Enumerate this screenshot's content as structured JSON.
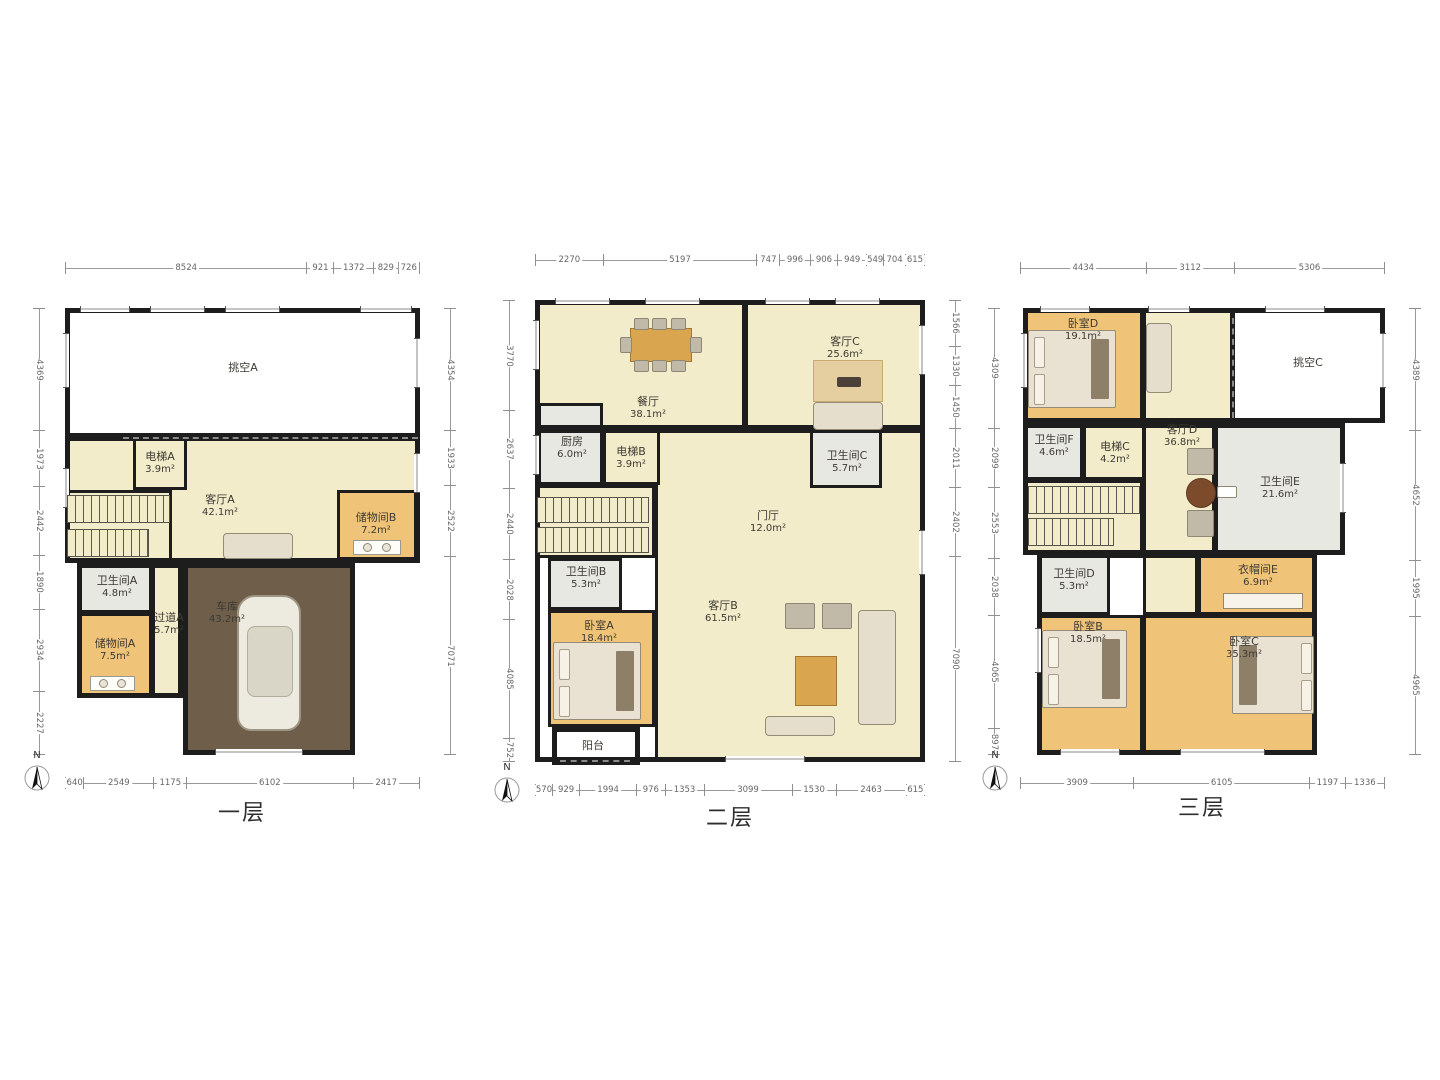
{
  "compass": {
    "label": "N"
  },
  "colors": {
    "floor": "#f3ecca",
    "wood": "#f0c478",
    "gray": "#e8e8e3",
    "garage": "#6e5e4a",
    "void": "#ffffff",
    "wall": "#1d1d1d",
    "dim_text": "#666666"
  },
  "floors": [
    {
      "label": "一层",
      "plan": {
        "x": 65,
        "y": 308,
        "w": 355,
        "h": 447
      },
      "label_pos": {
        "x": 242,
        "y": 795
      },
      "compass_pos": {
        "x": 22,
        "y": 750
      },
      "dims": {
        "top": [
          "8524",
          "921",
          "1372",
          "829",
          "726"
        ],
        "left": [
          "4369",
          "1973",
          "2442",
          "1890",
          "2934",
          "2227"
        ],
        "right": [
          "4354",
          "1933",
          "2522",
          "7071"
        ],
        "bottom": [
          "640",
          "2549",
          "1175",
          "6102",
          "2417"
        ]
      },
      "rooms": [
        {
          "key": "void-a",
          "name": "挑空A",
          "area": "",
          "x": 0,
          "y": 0,
          "w": 355,
          "h": 130,
          "fill": "void",
          "lx": 178,
          "ly": 60
        },
        {
          "key": "living-a",
          "name": "客厅A",
          "area": "42.1m²",
          "x": 0,
          "y": 128,
          "w": 355,
          "h": 127,
          "fill": "floor",
          "lx": 155,
          "ly": 198
        },
        {
          "key": "elevator-a",
          "name": "电梯A",
          "area": "3.9m²",
          "x": 68,
          "y": 128,
          "w": 54,
          "h": 54,
          "fill": "floor",
          "lx": 95,
          "ly": 155
        },
        {
          "key": "storage-b",
          "name": "储物间B",
          "area": "7.2m²",
          "x": 272,
          "y": 182,
          "w": 80,
          "h": 70,
          "fill": "wood",
          "lx": 311,
          "ly": 216
        },
        {
          "key": "stairwell-1",
          "name": "",
          "area": "",
          "x": 0,
          "y": 182,
          "w": 107,
          "h": 73,
          "fill": "floor"
        },
        {
          "key": "bath-a",
          "name": "卫生间A",
          "area": "4.8m²",
          "x": 13,
          "y": 255,
          "w": 74,
          "h": 50,
          "fill": "gray",
          "lx": 52,
          "ly": 279
        },
        {
          "key": "corridor-a",
          "name": "过道A",
          "area": "5.7m²",
          "x": 87,
          "y": 255,
          "w": 31,
          "h": 135,
          "fill": "floor",
          "lx": 104,
          "ly": 316
        },
        {
          "key": "storage-a",
          "name": "储物间A",
          "area": "7.5m²",
          "x": 12,
          "y": 305,
          "w": 75,
          "h": 85,
          "fill": "wood",
          "lx": 50,
          "ly": 342
        },
        {
          "key": "garage",
          "name": "车库",
          "area": "43.2m²",
          "x": 118,
          "y": 255,
          "w": 172,
          "h": 192,
          "fill": "garage",
          "lx": 162,
          "ly": 305
        }
      ],
      "extra_labels": [],
      "walls": [
        {
          "x": 0,
          "y": 0,
          "w": 355,
          "h": 130
        },
        {
          "x": 0,
          "y": 128,
          "w": 355,
          "h": 127
        },
        {
          "x": 12,
          "y": 255,
          "w": 106,
          "h": 135
        },
        {
          "x": 118,
          "y": 255,
          "w": 172,
          "h": 192
        }
      ],
      "dashes": [
        {
          "x": 58,
          "y": 129,
          "w": 295
        }
      ],
      "windows": [
        {
          "x": 15,
          "y": -2,
          "w": 50,
          "h": 6
        },
        {
          "x": 85,
          "y": -2,
          "w": 55,
          "h": 6
        },
        {
          "x": 160,
          "y": -2,
          "w": 55,
          "h": 6
        },
        {
          "x": 295,
          "y": -2,
          "w": 52,
          "h": 6
        },
        {
          "x": -2,
          "y": 25,
          "w": 6,
          "h": 55
        },
        {
          "x": -2,
          "y": 160,
          "w": 6,
          "h": 40
        },
        {
          "x": 349,
          "y": 30,
          "w": 6,
          "h": 50
        },
        {
          "x": 349,
          "y": 145,
          "w": 6,
          "h": 40
        },
        {
          "x": 150,
          "y": 441,
          "w": 88,
          "h": 6
        }
      ],
      "furniture": [
        {
          "type": "stairs",
          "x": 2,
          "y": 187,
          "w": 103,
          "h": 28
        },
        {
          "type": "stairs",
          "x": 2,
          "y": 221,
          "w": 82,
          "h": 28
        },
        {
          "type": "sofa",
          "x": 158,
          "y": 225,
          "w": 70,
          "h": 26
        },
        {
          "type": "car",
          "x": 172,
          "y": 287,
          "w": 64,
          "h": 136
        },
        {
          "type": "washer",
          "x": 25,
          "y": 368,
          "w": 45,
          "h": 15
        },
        {
          "type": "washer",
          "x": 288,
          "y": 232,
          "w": 48,
          "h": 15
        }
      ]
    },
    {
      "label": "二层",
      "plan": {
        "x": 535,
        "y": 300,
        "w": 390,
        "h": 462
      },
      "label_pos": {
        "x": 730,
        "y": 800
      },
      "compass_pos": {
        "x": 492,
        "y": 762
      },
      "dims": {
        "top": [
          "2270",
          "5197",
          "747",
          "996",
          "906",
          "949",
          "549",
          "704",
          "615"
        ],
        "left": [
          "3770",
          "2637",
          "2440",
          "2028",
          "4085",
          "752"
        ],
        "right": [
          "1566",
          "1330",
          "1450",
          "2011",
          "2402",
          "7090"
        ],
        "bottom": [
          "570",
          "929",
          "1994",
          "976",
          "1353",
          "3099",
          "1530",
          "2463",
          "615"
        ]
      },
      "rooms": [
        {
          "key": "dining",
          "name": "餐厅",
          "area": "38.1m²",
          "x": 0,
          "y": 0,
          "w": 210,
          "h": 128,
          "fill": "floor",
          "lx": 113,
          "ly": 108
        },
        {
          "key": "living-c",
          "name": "客厅C",
          "area": "25.6m²",
          "x": 210,
          "y": 0,
          "w": 180,
          "h": 130,
          "fill": "floor",
          "lx": 310,
          "ly": 48
        },
        {
          "key": "hall-living-b",
          "name": "客厅B",
          "area": "61.5m²",
          "x": 120,
          "y": 128,
          "w": 270,
          "h": 334,
          "fill": "floor",
          "lx": 188,
          "ly": 312
        },
        {
          "key": "kitchen",
          "name": "厨房",
          "area": "6.0m²",
          "x": 3,
          "y": 103,
          "w": 65,
          "h": 82,
          "fill": "gray",
          "lx": 37,
          "ly": 148
        },
        {
          "key": "elevator-b",
          "name": "电梯B",
          "area": "3.9m²",
          "x": 68,
          "y": 128,
          "w": 57,
          "h": 57,
          "fill": "floor",
          "lx": 96,
          "ly": 158
        },
        {
          "key": "bath-c",
          "name": "卫生间C",
          "area": "5.7m²",
          "x": 275,
          "y": 128,
          "w": 72,
          "h": 60,
          "fill": "gray",
          "lx": 312,
          "ly": 162
        },
        {
          "key": "stairwell-2",
          "name": "",
          "area": "",
          "x": 0,
          "y": 185,
          "w": 120,
          "h": 73,
          "fill": "floor"
        },
        {
          "key": "bath-b",
          "name": "卫生间B",
          "area": "5.3m²",
          "x": 13,
          "y": 258,
          "w": 74,
          "h": 52,
          "fill": "gray",
          "lx": 51,
          "ly": 278
        },
        {
          "key": "bedroom-a",
          "name": "卧室A",
          "area": "18.4m²",
          "x": 13,
          "y": 310,
          "w": 107,
          "h": 117,
          "fill": "wood",
          "lx": 64,
          "ly": 332
        },
        {
          "key": "balcony",
          "name": "阳台",
          "area": "",
          "x": 17,
          "y": 427,
          "w": 88,
          "h": 38,
          "fill": "void",
          "lx": 58,
          "ly": 446
        }
      ],
      "extra_labels": [
        {
          "name": "门厅",
          "area": "12.0m²",
          "x": 233,
          "y": 222
        }
      ],
      "walls": [
        {
          "x": 0,
          "y": 0,
          "w": 390,
          "h": 130
        },
        {
          "x": 0,
          "y": 128,
          "w": 390,
          "h": 334
        },
        {
          "x": 17,
          "y": 427,
          "w": 88,
          "h": 38
        }
      ],
      "dashes": [
        {
          "x": 25,
          "y": 460,
          "w": 70
        }
      ],
      "windows": [
        {
          "x": 20,
          "y": -2,
          "w": 55,
          "h": 6
        },
        {
          "x": 110,
          "y": -2,
          "w": 55,
          "h": 6
        },
        {
          "x": 230,
          "y": -2,
          "w": 45,
          "h": 6
        },
        {
          "x": 300,
          "y": -2,
          "w": 45,
          "h": 6
        },
        {
          "x": -2,
          "y": 20,
          "w": 6,
          "h": 50
        },
        {
          "x": -2,
          "y": 135,
          "w": 6,
          "h": 40
        },
        {
          "x": 384,
          "y": 25,
          "w": 6,
          "h": 50
        },
        {
          "x": 384,
          "y": 230,
          "w": 6,
          "h": 45
        },
        {
          "x": 190,
          "y": 456,
          "w": 80,
          "h": 6
        }
      ],
      "furniture": [
        {
          "type": "table8",
          "x": 85,
          "y": 18,
          "w": 80,
          "h": 52
        },
        {
          "type": "rug",
          "x": 278,
          "y": 60,
          "w": 70,
          "h": 42
        },
        {
          "type": "sofa",
          "x": 278,
          "y": 102,
          "w": 70,
          "h": 28
        },
        {
          "type": "stairs",
          "x": 2,
          "y": 197,
          "w": 112,
          "h": 26
        },
        {
          "type": "stairs",
          "x": 2,
          "y": 227,
          "w": 112,
          "h": 26
        },
        {
          "type": "bed",
          "x": 18,
          "y": 342,
          "w": 88,
          "h": 78,
          "side": "l"
        },
        {
          "type": "sofaset",
          "x": 215,
          "y": 298,
          "w": 150,
          "h": 140
        }
      ]
    },
    {
      "label": "三层",
      "plan": {
        "x": 1020,
        "y": 308,
        "w": 365,
        "h": 447
      },
      "label_pos": {
        "x": 1202,
        "y": 790
      },
      "compass_pos": {
        "x": 980,
        "y": 750
      },
      "dims": {
        "top": [
          "4434",
          "3112",
          "5306"
        ],
        "left": [
          "4309",
          "2099",
          "2553",
          "2038",
          "4065",
          "897"
        ],
        "right": [
          "4389",
          "4652",
          "1995",
          "4965"
        ],
        "bottom": [
          "3909",
          "6105",
          "1197",
          "1336"
        ]
      },
      "rooms": [
        {
          "key": "bedroom-d",
          "name": "卧室D",
          "area": "19.1m²",
          "x": 3,
          "y": 0,
          "w": 120,
          "h": 115,
          "fill": "wood",
          "lx": 63,
          "ly": 22
        },
        {
          "key": "living-d-top",
          "name": "",
          "area": "",
          "x": 123,
          "y": 0,
          "w": 90,
          "h": 115,
          "fill": "floor"
        },
        {
          "key": "void-c",
          "name": "挑空C",
          "area": "",
          "x": 212,
          "y": 0,
          "w": 153,
          "h": 115,
          "fill": "void",
          "lx": 288,
          "ly": 55
        },
        {
          "key": "living-d",
          "name": "客厅D",
          "area": "36.8m²",
          "x": 123,
          "y": 115,
          "w": 72,
          "h": 132,
          "fill": "floor",
          "lx": 162,
          "ly": 128
        },
        {
          "key": "bath-f",
          "name": "卫生间F",
          "area": "4.6m²",
          "x": 3,
          "y": 115,
          "w": 60,
          "h": 57,
          "fill": "gray",
          "lx": 34,
          "ly": 138
        },
        {
          "key": "elevator-c",
          "name": "电梯C",
          "area": "4.2m²",
          "x": 63,
          "y": 115,
          "w": 62,
          "h": 57,
          "fill": "floor",
          "lx": 95,
          "ly": 145
        },
        {
          "key": "stairwell-3",
          "name": "",
          "area": "",
          "x": 3,
          "y": 172,
          "w": 120,
          "h": 75,
          "fill": "floor"
        },
        {
          "key": "bath-e",
          "name": "卫生间E",
          "area": "21.6m²",
          "x": 195,
          "y": 115,
          "w": 130,
          "h": 132,
          "fill": "gray",
          "lx": 260,
          "ly": 180
        },
        {
          "key": "hall-3",
          "name": "",
          "area": "",
          "x": 123,
          "y": 245,
          "w": 55,
          "h": 62,
          "fill": "floor"
        },
        {
          "key": "bath-d",
          "name": "卫生间D",
          "area": "5.3m²",
          "x": 17,
          "y": 245,
          "w": 73,
          "h": 62,
          "fill": "gray",
          "lx": 54,
          "ly": 272
        },
        {
          "key": "cloak-e",
          "name": "衣帽间E",
          "area": "6.9m²",
          "x": 178,
          "y": 245,
          "w": 119,
          "h": 62,
          "fill": "wood",
          "lx": 238,
          "ly": 268
        },
        {
          "key": "bedroom-b",
          "name": "卧室B",
          "area": "18.5m²",
          "x": 17,
          "y": 307,
          "w": 106,
          "h": 140,
          "fill": "wood",
          "lx": 68,
          "ly": 325
        },
        {
          "key": "bedroom-c",
          "name": "卧室C",
          "area": "35.3m²",
          "x": 123,
          "y": 307,
          "w": 174,
          "h": 140,
          "fill": "wood",
          "lx": 224,
          "ly": 340
        }
      ],
      "extra_labels": [],
      "walls": [
        {
          "x": 3,
          "y": 0,
          "w": 362,
          "h": 115
        },
        {
          "x": 3,
          "y": 115,
          "w": 322,
          "h": 132
        },
        {
          "x": 17,
          "y": 245,
          "w": 280,
          "h": 202
        }
      ],
      "dashes": [
        {
          "x": 212,
          "y": 10,
          "w": 0,
          "h": 100
        }
      ],
      "windows": [
        {
          "x": 20,
          "y": -2,
          "w": 50,
          "h": 6
        },
        {
          "x": 128,
          "y": -2,
          "w": 42,
          "h": 6
        },
        {
          "x": 245,
          "y": -2,
          "w": 60,
          "h": 6
        },
        {
          "x": 1,
          "y": 25,
          "w": 6,
          "h": 55
        },
        {
          "x": 15,
          "y": 320,
          "w": 6,
          "h": 45
        },
        {
          "x": 360,
          "y": 25,
          "w": 6,
          "h": 55
        },
        {
          "x": 320,
          "y": 155,
          "w": 6,
          "h": 50
        },
        {
          "x": 160,
          "y": 441,
          "w": 85,
          "h": 6
        },
        {
          "x": 40,
          "y": 441,
          "w": 60,
          "h": 6
        }
      ],
      "furniture": [
        {
          "type": "bed",
          "x": 8,
          "y": 22,
          "w": 88,
          "h": 78,
          "side": "l"
        },
        {
          "type": "sofa",
          "x": 126,
          "y": 15,
          "w": 26,
          "h": 70
        },
        {
          "type": "stairs",
          "x": 8,
          "y": 178,
          "w": 112,
          "h": 28
        },
        {
          "type": "stairs",
          "x": 8,
          "y": 210,
          "w": 86,
          "h": 28
        },
        {
          "type": "rtableset",
          "x": 165,
          "y": 140,
          "w": 30,
          "h": 88
        },
        {
          "type": "basin",
          "x": 197,
          "y": 178,
          "w": 20,
          "h": 12
        },
        {
          "type": "wardrobe",
          "x": 203,
          "y": 285,
          "w": 80,
          "h": 16
        },
        {
          "type": "bed",
          "x": 22,
          "y": 322,
          "w": 85,
          "h": 78,
          "side": "l"
        },
        {
          "type": "bed",
          "x": 212,
          "y": 328,
          "w": 82,
          "h": 78,
          "side": "r"
        }
      ]
    }
  ]
}
